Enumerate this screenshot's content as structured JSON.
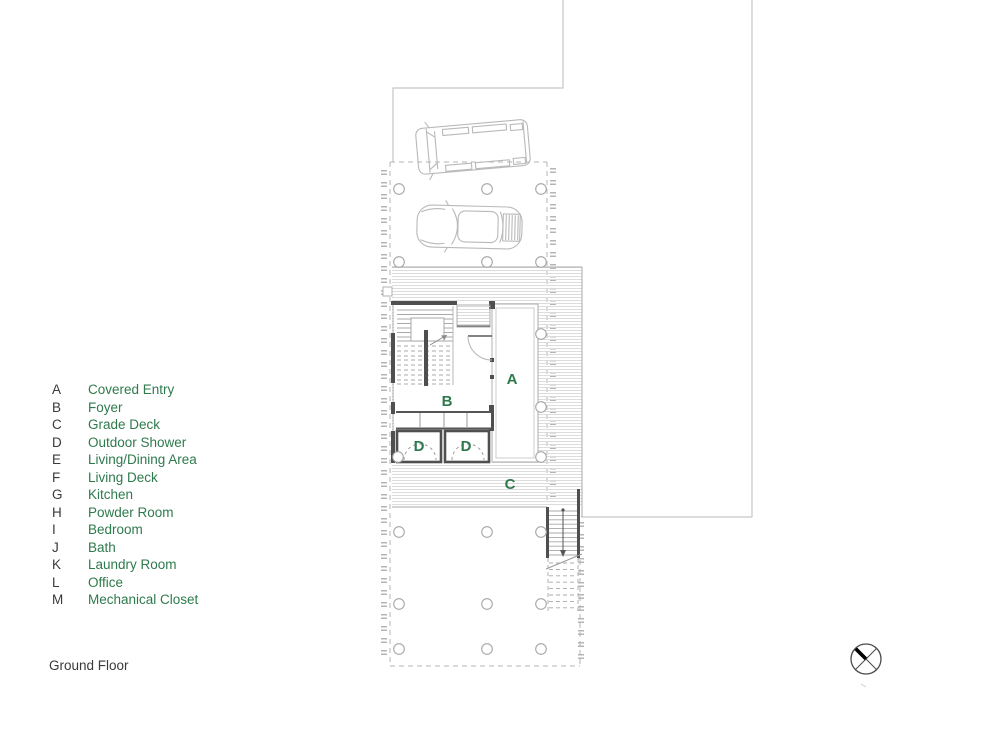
{
  "drawing": {
    "title": "Ground Floor"
  },
  "colors": {
    "accent_green": "#2e7a4d",
    "ink": "#3a3a3a",
    "wall_dark": "#4f4f4f",
    "light_line": "#c6c6c6"
  },
  "legend": {
    "items": [
      {
        "letter": "A",
        "label": "Covered Entry"
      },
      {
        "letter": "B",
        "label": "Foyer"
      },
      {
        "letter": "C",
        "label": "Grade Deck"
      },
      {
        "letter": "D",
        "label": "Outdoor Shower"
      },
      {
        "letter": "E",
        "label": "Living/Dining Area"
      },
      {
        "letter": "F",
        "label": "Living Deck"
      },
      {
        "letter": "G",
        "label": "Kitchen"
      },
      {
        "letter": "H",
        "label": "Powder Room"
      },
      {
        "letter": "I",
        "label": "Bedroom"
      },
      {
        "letter": "J",
        "label": "Bath"
      },
      {
        "letter": "K",
        "label": "Laundry Room"
      },
      {
        "letter": "L",
        "label": "Office"
      },
      {
        "letter": "M",
        "label": "Mechanical Closet"
      }
    ]
  },
  "plan": {
    "labels": [
      "A",
      "B",
      "C",
      "D",
      "D"
    ]
  }
}
